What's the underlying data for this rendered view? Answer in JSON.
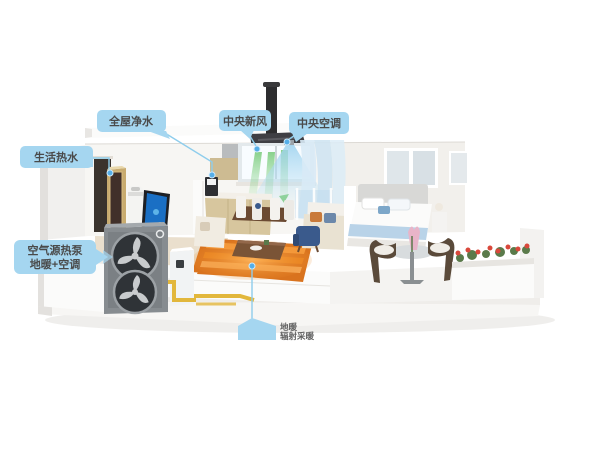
{
  "callouts": {
    "water_purification": {
      "label": "全屋净水"
    },
    "domestic_hot_water": {
      "label": "生活热水"
    },
    "fresh_air": {
      "label": "中央新风"
    },
    "central_ac": {
      "label": "中央空调"
    },
    "heat_pump": {
      "label_line1": "空气源热泵",
      "label_line2": "地暖+空调"
    },
    "floor_heating": {
      "label_line1": "地暖",
      "label_line2": "辐射采暖"
    }
  },
  "colors": {
    "callout_bubble": "#a5d6f0",
    "callout_line": "#8ecdec",
    "callout_text": "#4a4a4a",
    "fresh_air_green": "#3fb53f",
    "cool_air_blue": "#9cd1ee",
    "floor_heating_orange": "#e8821e",
    "pipe_yellow": "#e2b73c",
    "heat_pump_gray": "#878c90",
    "water_tank_gold": "#c8ab6f",
    "flower_red": "#d9483b"
  }
}
